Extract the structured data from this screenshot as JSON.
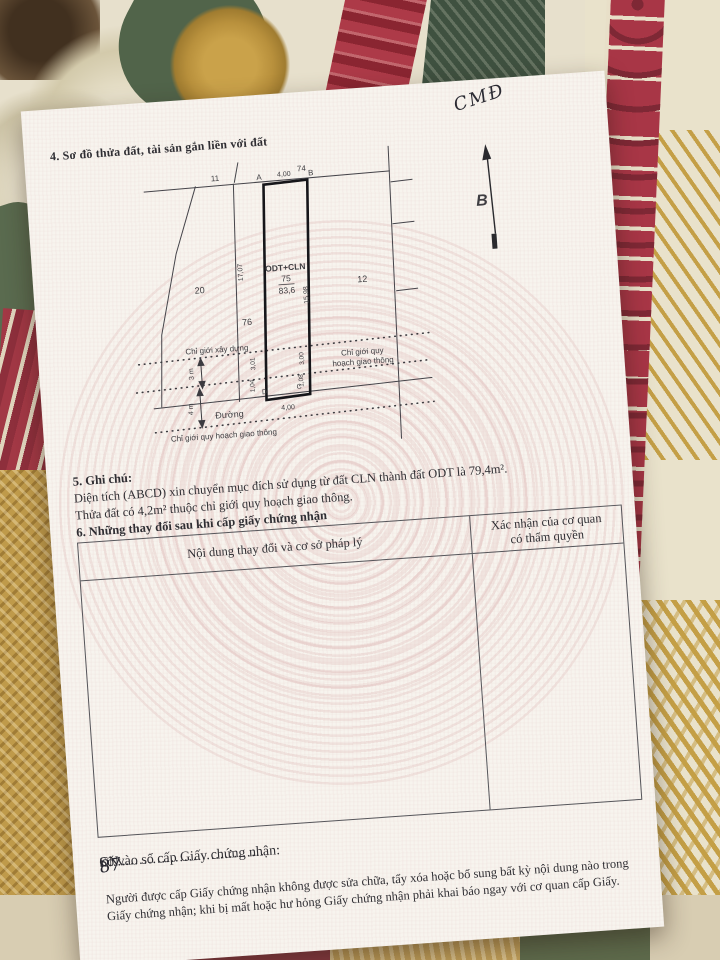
{
  "certificate": {
    "handwritten_note": "CMĐ",
    "section4": {
      "title": "4. Sơ đồ thửa đất, tài sản gắn liền với đất"
    },
    "diagram": {
      "north_arrow_label": "B",
      "neighbor_parcels": {
        "p11": "11",
        "p74": "74",
        "p20": "20",
        "p76": "76",
        "p12": "12"
      },
      "plot": {
        "land_use_code": "ODT+CLN",
        "parcel_number": "75",
        "area_m2": "83,6",
        "corner_a": "A",
        "corner_b": "B",
        "corner_c": "C",
        "corner_d": "D",
        "edge_top": "4,00",
        "edge_bottom": "4,00",
        "edge_left": "17,07",
        "edge_right": "15,98",
        "seg_left_upper": "3,01",
        "seg_left_lower": "1,04",
        "seg_right_upper": "3,00",
        "seg_right_lower": "1,08"
      },
      "boundary_labels": {
        "construction": "Chỉ giới xây dựng",
        "planning_right_line1": "Chỉ giới quy",
        "planning_right_line2": "hoạch giao thông",
        "planning_bottom": "Chỉ giới quy hoạch giao thông",
        "road": "Đường",
        "setback_3m": "3 m",
        "setback_4m": "4 m"
      }
    },
    "section5": {
      "title": "5. Ghi chú:",
      "note1": "Diện tích (ABCD) xin chuyển mục đích sử dụng từ đất CLN thành đất ODT là 79,4m².",
      "note2": "Thửa đất có 4,2m² thuộc chỉ giới quy hoạch giao thông."
    },
    "section6": {
      "title": "6. Những thay đổi sau khi cấp giấy chứng nhận",
      "col_content": "Nội dung thay đổi và cơ sở pháp lý",
      "col_confirm_line1": "Xác nhận của cơ quan",
      "col_confirm_line2": "có thẩm quyền"
    },
    "footer": {
      "serial_label": "Số vào sổ cấp Giấy chứng nhận:",
      "serial_dots1": "..",
      "serial_prefix": "CN",
      "serial_dots2": "......",
      "serial_number": "87",
      "serial_dots3": "................................",
      "notice_line1": "Người được cấp Giấy chứng nhận không được sửa chữa, tẩy xóa hoặc bổ sung bất kỳ nội dung nào trong",
      "notice_line2": "Giấy chứng nhận; khi bị mất hoặc hư hỏng Giấy chứng nhận phải khai báo ngay với cơ quan cấp Giấy."
    }
  }
}
